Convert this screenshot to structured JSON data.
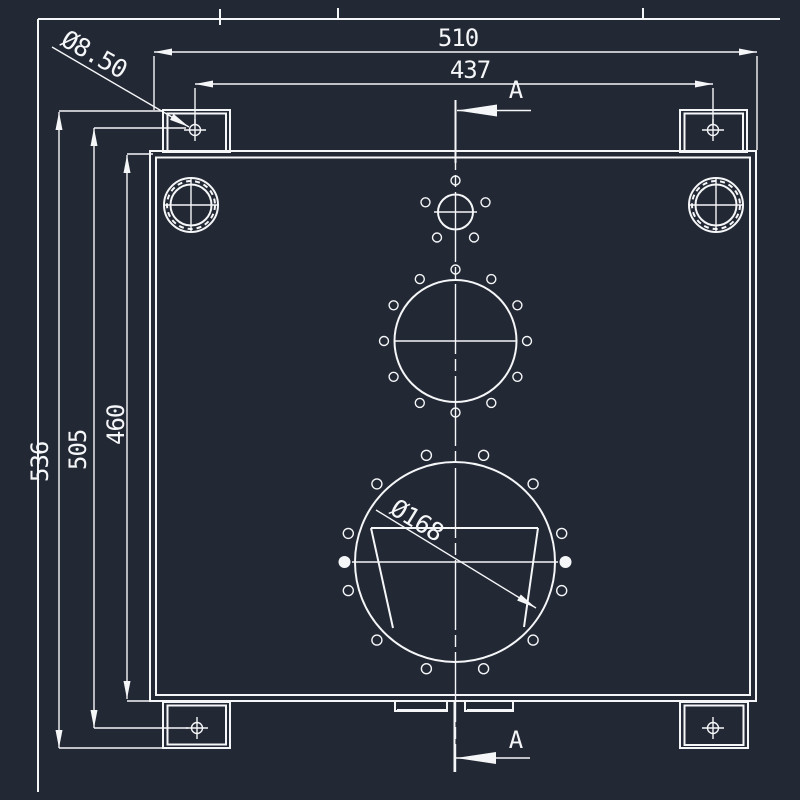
{
  "drawing": {
    "background_color": "#222834",
    "line_color": "#f5f6f8",
    "dimensions": {
      "overall_width": "510",
      "mount_hole_span_width": "437",
      "overall_height": "536",
      "mount_hole_span_height": "505",
      "body_height": "460",
      "mount_hole_diameter": "Ø8.50",
      "large_opening_diameter": "Ø168"
    },
    "section_label_top": "A",
    "section_label_bottom": "A"
  }
}
